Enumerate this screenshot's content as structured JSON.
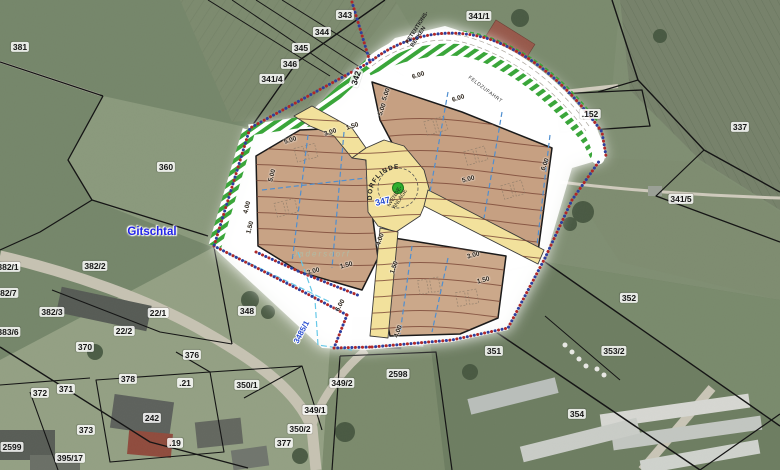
{
  "place": {
    "region_label": "Gitschtal",
    "village_label": "Jadersdorf"
  },
  "plan": {
    "retention_line1": "RETENTIONS-",
    "retention_line2": "BECKEN",
    "feldzufahrt_label": "FELDZUFAHRT",
    "dorflinde_label": "DORFLINDE",
    "wende_line1": "WENDE-",
    "wende_line2": "ANLAGE",
    "road_parcel_label": "347",
    "road_parcel_label_2": "3485/1",
    "tree_symbol_color": "#2fae2f",
    "hatch_color": "#3aa63a",
    "lot_fill_color": "#c8a385",
    "road_fill_color": "#f2e19c"
  },
  "parcels": {
    "p381": "381",
    "p343": "343",
    "p344": "344",
    "p345": "345",
    "p346": "346",
    "p341_4": "341/4",
    "p342": "342",
    "p341_1": "341/1",
    "p152": ".152",
    "p337": "337",
    "p360": "360",
    "p341_5": "341/5",
    "p382_2": "382/2",
    "p382_1": "382/1",
    "p382_7": "382/7",
    "p382_3": "382/3",
    "p383_6": "383/6",
    "p22_1": "22/1",
    "p22_2": "22/2",
    "p348": "348",
    "p370": "370",
    "p376": "376",
    "p378": "378",
    "p371": "371",
    "p372": "372",
    "p21": ".21",
    "p373": "373",
    "p19": ".19",
    "p2599": "2599",
    "p395_17": "395/17",
    "p350_1": "350/1",
    "p242": "242",
    "p349_2": "349/2",
    "p349_1": "349/1",
    "p350_2": "350/2",
    "p377": "377",
    "p2598": "2598",
    "p351": "351",
    "p352": "352",
    "p353_2": "353/2",
    "p354": "354"
  },
  "dims": [
    "5.00",
    "3.00",
    "1.50",
    "4.00",
    "1.50",
    "6.00",
    "5.00",
    "5.00",
    "6.00",
    "6.00",
    "5.00",
    "4.00",
    "1.50",
    "3.00",
    "1.50",
    "6.00",
    "3.00",
    "1.50",
    "4.00",
    "5.00"
  ]
}
